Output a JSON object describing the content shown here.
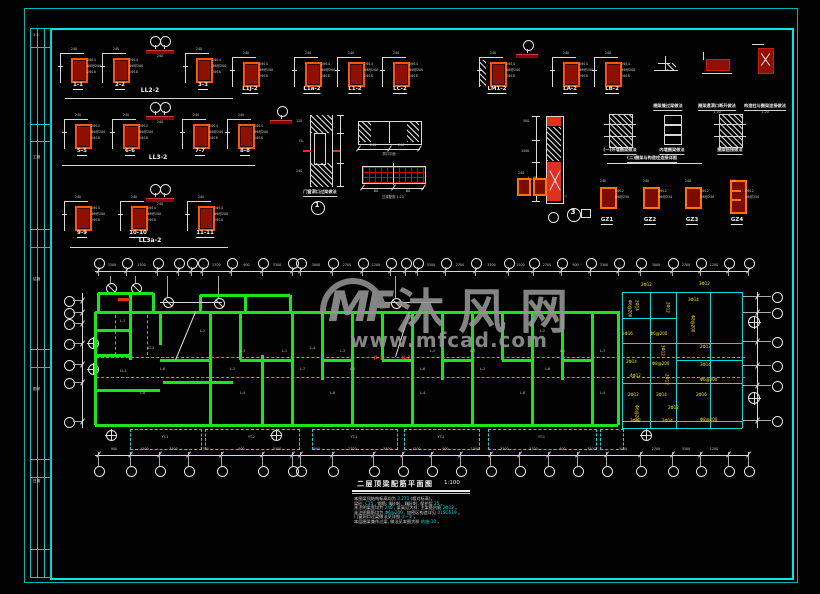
{
  "watermark": {
    "logo": "MF",
    "brand": "沐风网",
    "url": "www.mfcad.com"
  },
  "strip": {
    "cells": [
      {
        "y": 4,
        "t": "1 2"
      },
      {
        "y": 126,
        "t": "工程"
      },
      {
        "y": 248,
        "t": "结施"
      },
      {
        "y": 358,
        "t": "图号"
      },
      {
        "y": 450,
        "t": "日期"
      }
    ]
  },
  "rows": [
    {
      "y": 50,
      "group": "LL2-2",
      "gx": 150,
      "gy": 89,
      "ul": [
        65,
        233,
        98
      ],
      "marker": [
        160,
        36
      ],
      "items": [
        {
          "x": 78,
          "l": "1-1"
        },
        {
          "x": 120,
          "l": "2-2"
        },
        {
          "x": 203,
          "l": "3-3"
        }
      ]
    },
    {
      "y": 116,
      "group": "LL3-2",
      "gx": 158,
      "gy": 156,
      "ul": [
        62,
        255,
        165
      ],
      "marker": [
        160,
        102
      ],
      "items": [
        {
          "x": 82,
          "l": "5-5"
        },
        {
          "x": 130,
          "l": "6-6"
        },
        {
          "x": 200,
          "l": "7-7"
        },
        {
          "x": 245,
          "l": "8-8"
        }
      ]
    },
    {
      "y": 198,
      "group": "LL3a-2",
      "gx": 150,
      "gy": 239,
      "ul": [
        70,
        228,
        247
      ],
      "marker": [
        160,
        184
      ],
      "items": [
        {
          "x": 82,
          "l": "9-9"
        },
        {
          "x": 138,
          "l": "10-10"
        },
        {
          "x": 205,
          "l": "11-11"
        }
      ]
    }
  ],
  "beam_sections": [
    {
      "x": 250,
      "l": "L1J-2"
    },
    {
      "x": 312,
      "l": "L1a-2"
    },
    {
      "x": 355,
      "l": "L1-2"
    },
    {
      "x": 400,
      "l": "LC-2"
    },
    {
      "x": 497,
      "l": "LM1-2",
      "h": true
    },
    {
      "x": 570,
      "l": "LA-2"
    },
    {
      "x": 612,
      "l": "LB-2"
    }
  ],
  "section_texts": {
    "top": "240",
    "r1": "2Φ14",
    "r2": "Φ6@200",
    "r3": "2Φ18"
  },
  "single_markers": [
    [
      281,
      106
    ],
    [
      527,
      40
    ]
  ],
  "details": {
    "wall_caption": "门窗洞口过梁做法",
    "beam_plan_caption": "洞口平面",
    "red_beam_caption": "过梁配筋 1:25",
    "tall_note": "l=45",
    "top_right": [
      {
        "cap": "圈梁兼过梁做法"
      },
      {
        "cap": "圈梁遇洞口断开做法",
        "sub": "1:20"
      },
      {
        "cap": "构造柱与圈梁连接做法",
        "sub": "1:20"
      }
    ],
    "mid_right": [
      {
        "cap": "(一)外墙圈梁做法"
      },
      {
        "cap": "内墙圈梁做法"
      },
      {
        "cap": "圈梁搭接做法"
      }
    ],
    "long_caption": "(二)圈梁与构造柱连接详图"
  },
  "gz": [
    {
      "x": 607,
      "l": "GZ1"
    },
    {
      "x": 650,
      "l": "GZ2"
    },
    {
      "x": 692,
      "l": "GZ3"
    },
    {
      "x": 737,
      "l": "GZ4",
      "tall": true
    }
  ],
  "callouts": [
    {
      "x": 317,
      "y": 207,
      "n": "1"
    },
    {
      "x": 573,
      "y": 214,
      "n": "3"
    }
  ],
  "plan": {
    "top_bubbles": [
      98,
      126,
      157,
      178,
      191,
      202,
      231,
      262,
      292,
      300,
      332,
      362,
      390,
      405,
      417,
      445,
      475,
      508,
      533,
      561,
      590,
      618,
      640,
      672,
      700,
      728,
      748
    ],
    "bottom_bubbles": [
      98,
      130,
      159,
      188,
      221,
      262,
      292,
      300,
      332,
      373,
      402,
      431,
      460,
      490,
      519,
      548,
      577,
      606,
      640,
      672,
      700,
      728,
      748
    ],
    "left_bubbles": [
      300,
      312,
      323,
      343,
      364,
      382,
      421
    ],
    "right_bubbles": [
      296,
      312,
      341,
      365,
      385,
      420
    ],
    "right_cross": [
      [
        753,
        321
      ],
      [
        753,
        397
      ]
    ],
    "sub_bubbles": [
      [
        110,
        287
      ],
      [
        135,
        287
      ],
      [
        167,
        301
      ],
      [
        218,
        302
      ],
      [
        395,
        302
      ]
    ],
    "cross_circles": [
      [
        92,
        342
      ],
      [
        92,
        368
      ],
      [
        110,
        434
      ],
      [
        275,
        434
      ],
      [
        645,
        434
      ]
    ],
    "top_dims": [
      "3300",
      "1500",
      "2700",
      "900",
      "3300",
      "3000",
      "2700",
      "1200",
      "3300",
      "2700"
    ],
    "bottom_dims": [
      "900",
      "1500",
      "3300",
      "2700",
      "600",
      "3300",
      "3000",
      "2700",
      "3300",
      "1200"
    ],
    "green_v": [
      [
        312,
        425,
        95
      ],
      [
        312,
        360,
        130
      ],
      [
        312,
        345,
        160
      ],
      [
        312,
        425,
        210
      ],
      [
        312,
        360,
        240
      ],
      [
        355,
        425,
        262
      ],
      [
        312,
        425,
        292
      ],
      [
        312,
        380,
        322
      ],
      [
        312,
        425,
        352
      ],
      [
        312,
        360,
        382
      ],
      [
        312,
        425,
        412
      ],
      [
        312,
        380,
        442
      ],
      [
        312,
        425,
        472
      ],
      [
        312,
        360,
        502
      ],
      [
        312,
        425,
        532
      ],
      [
        312,
        380,
        562
      ],
      [
        312,
        425,
        592
      ],
      [
        312,
        425,
        618
      ],
      [
        293,
        312,
        98
      ],
      [
        293,
        312,
        130
      ],
      [
        293,
        312,
        153
      ],
      [
        295,
        312,
        200
      ],
      [
        295,
        312,
        245
      ],
      [
        295,
        312,
        290
      ]
    ],
    "green_h": [
      [
        95,
        620,
        312
      ],
      [
        95,
        618,
        425
      ],
      [
        98,
        153,
        293
      ],
      [
        200,
        290,
        295
      ],
      [
        95,
        130,
        330
      ],
      [
        95,
        130,
        355
      ],
      [
        95,
        160,
        390
      ],
      [
        163,
        233,
        382
      ],
      [
        160,
        210,
        360
      ],
      [
        240,
        292,
        360
      ],
      [
        322,
        352,
        360
      ],
      [
        382,
        412,
        360
      ],
      [
        442,
        472,
        360
      ],
      [
        502,
        532,
        360
      ],
      [
        562,
        592,
        360
      ]
    ],
    "cyan_dash_h": [
      [
        96,
        745,
        357
      ],
      [
        96,
        745,
        377
      ]
    ],
    "cyan_dash_v": [
      [
        315,
        355,
        115
      ],
      [
        315,
        355,
        147
      ]
    ],
    "wing_v": [
      [
        292,
        428,
        622
      ],
      [
        292,
        428,
        650
      ],
      [
        292,
        428,
        676
      ],
      [
        292,
        428,
        710
      ],
      [
        292,
        428,
        742
      ]
    ],
    "wing_h": [
      [
        622,
        742,
        292
      ],
      [
        622,
        742,
        343
      ],
      [
        622,
        742,
        383
      ],
      [
        622,
        742,
        421
      ],
      [
        622,
        742,
        428
      ],
      [
        622,
        676,
        318
      ],
      [
        676,
        742,
        360
      ]
    ],
    "balconies": [
      [
        130,
        200
      ],
      [
        205,
        298
      ],
      [
        312,
        396
      ],
      [
        404,
        478
      ],
      [
        488,
        595
      ],
      [
        600,
        622
      ]
    ],
    "balcony_labels": [
      "YT-1",
      "YT-2",
      "YT-1",
      "YT-2",
      "YT-1",
      ""
    ],
    "inner_dims": [
      [
        160,
        222,
        302
      ],
      [
        385,
        440,
        302
      ]
    ],
    "diagonals": [
      [
        410,
        312,
        396,
        357
      ],
      [
        196,
        312,
        176,
        360
      ]
    ],
    "diag_text": {
      "t": "4.50",
      "x": 401,
      "y": 328
    },
    "white_labels": [
      [
        120,
        320,
        "L-1"
      ],
      [
        200,
        330,
        "L-2"
      ],
      [
        148,
        347,
        "LT-1"
      ],
      [
        240,
        350,
        "L-3"
      ],
      [
        282,
        350,
        "L-1"
      ],
      [
        310,
        347,
        "L-4"
      ],
      [
        340,
        350,
        "L-3"
      ],
      [
        430,
        350,
        "L-5"
      ],
      [
        470,
        350,
        "L-3"
      ],
      [
        540,
        330,
        "L-2"
      ],
      [
        560,
        350,
        "L-1"
      ],
      [
        600,
        350,
        "L-3"
      ],
      [
        120,
        370,
        "LL-1"
      ],
      [
        160,
        368,
        "L-6"
      ],
      [
        230,
        368,
        "L-2"
      ],
      [
        300,
        368,
        "L-7"
      ],
      [
        350,
        368,
        "L-2"
      ],
      [
        420,
        368,
        "L-6"
      ],
      [
        480,
        368,
        "L-2"
      ],
      [
        545,
        368,
        "L-6"
      ],
      [
        140,
        392,
        "L-8"
      ],
      [
        240,
        392,
        "L-4"
      ],
      [
        330,
        392,
        "L-8"
      ],
      [
        420,
        392,
        "L-4"
      ],
      [
        520,
        392,
        "L-8"
      ],
      [
        600,
        392,
        "L-4"
      ]
    ],
    "red_labels": [
      [
        374,
        356,
        "JL-1"
      ],
      [
        402,
        356,
        "JL-2"
      ]
    ],
    "yellow_labels": [
      [
        641,
        283,
        "2Φ12",
        0
      ],
      [
        699,
        282,
        "3Φ12",
        0
      ],
      [
        627,
        300,
        "Φ6@200",
        1
      ],
      [
        634,
        300,
        "2Φ14",
        1
      ],
      [
        665,
        302,
        "2Φ12",
        1
      ],
      [
        688,
        298,
        "3Φ14",
        0
      ],
      [
        690,
        315,
        "Φ8@200",
        1
      ],
      [
        622,
        332,
        "2Φ16",
        0
      ],
      [
        650,
        332,
        "Φ6@200",
        0
      ],
      [
        660,
        345,
        "3Φ12",
        1
      ],
      [
        700,
        345,
        "2Φ12",
        0
      ],
      [
        626,
        360,
        "2Φ14",
        0
      ],
      [
        652,
        362,
        "Φ8@200",
        0
      ],
      [
        700,
        363,
        "3Φ14",
        0
      ],
      [
        630,
        374,
        "4Φ12",
        0
      ],
      [
        664,
        374,
        "2Φ12",
        1
      ],
      [
        700,
        378,
        "Φ6@200",
        0
      ],
      [
        628,
        393,
        "2Φ12",
        0
      ],
      [
        656,
        393,
        "3Φ14",
        0
      ],
      [
        696,
        393,
        "2Φ16",
        0
      ],
      [
        634,
        405,
        "Φ6@200",
        1
      ],
      [
        668,
        406,
        "2Φ12",
        0
      ],
      [
        630,
        419,
        "3Φ12",
        0
      ],
      [
        662,
        419,
        "2Φ14",
        0
      ],
      [
        700,
        418,
        "Φ8@200",
        0
      ]
    ]
  },
  "titleblock": {
    "title": "二层顶梁配筋平面图",
    "scale": "1:100",
    "notes": [
      [
        "本图梁顶结构标高均为 ",
        "3.270",
        " (相对标高)。"
      ],
      [
        "梁砼: ",
        "C25",
        " , 钢筋: Ⅰ级(Φ)、Ⅱ级(Φ), 保护层 ",
        "25",
        " 。"
      ],
      [
        "未注明梁宽均为 ",
        "240",
        " , 梁高见大样; 主梁处吊筋 ",
        "2Φ12",
        " 。"
      ],
      [
        "未注明箍筋均为 ",
        "Φ6@200",
        " , 加密区构造详见 ",
        "01SG519",
        " 。"
      ],
      [
        "门窗洞口过梁做法见详图 ",
        "①~③",
        " 。"
      ],
      [
        "本层圈梁兼作过梁,  做法见本图大样  ",
        "结施-10",
        " 。"
      ]
    ]
  }
}
